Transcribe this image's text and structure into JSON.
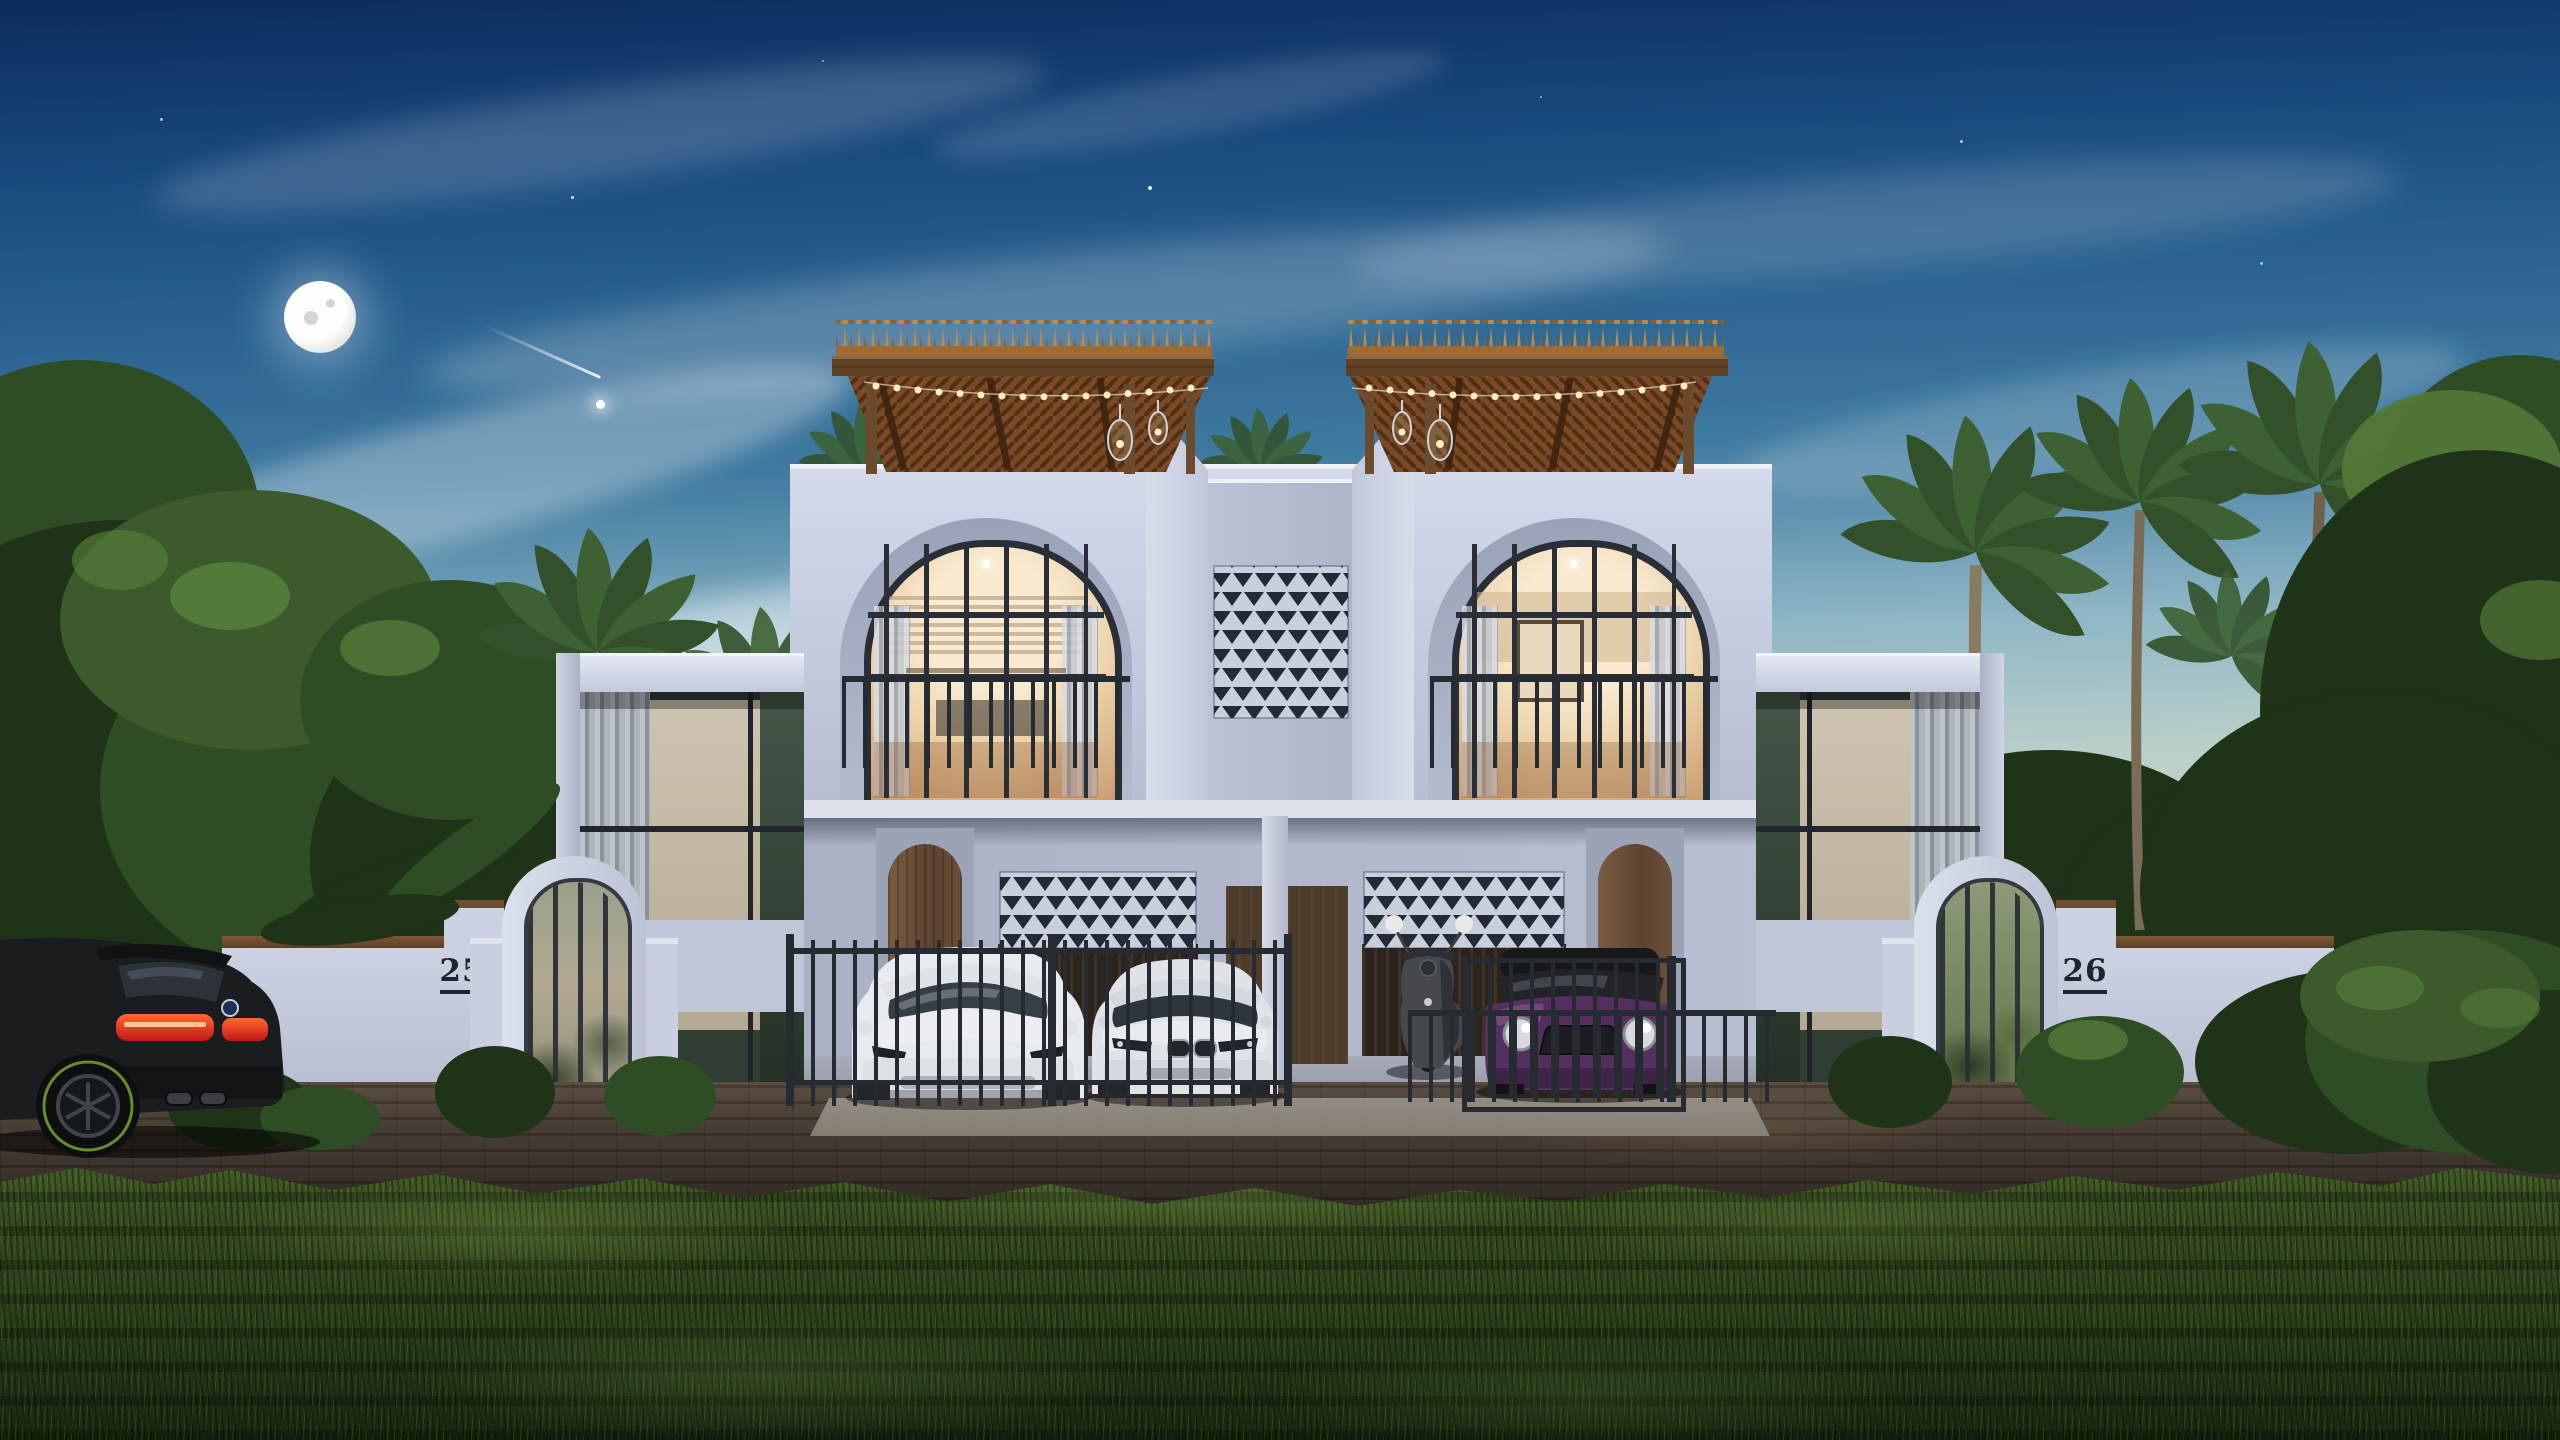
{
  "scene": {
    "left_unit_number": "25",
    "right_unit_number": "26"
  },
  "colors": {
    "skyTop": "#0b2c5c",
    "skyUpper": "#18497c",
    "skyMid": "#3f7aa0",
    "skyLow": "#8fb7c6",
    "skyHaze": "#d7d9c3",
    "horizon": "#f2e6c4",
    "cloud": "#ffffff",
    "moon": "#f4f6f0",
    "wallLight": "#d4daea",
    "wall": "#c6cdde",
    "wallMid": "#b6bdd0",
    "wallShade": "#a0a8bd",
    "nicheShade": "#9aa2b9",
    "frameDark": "#2a2f37",
    "glowTop": "#f9ead0",
    "glowMid": "#ecd3ab",
    "glowDeep": "#c49a6d",
    "woodDoor": "#6b4e36",
    "woodDark": "#4e3c2b",
    "thatchA": "#c08a45",
    "thatchB": "#8f5f2e",
    "fascia": "#5f4226",
    "soffit": "#7a4a26",
    "soffitLine": "#45280f",
    "post": "#6b4b2c",
    "bulb": "#ffedbe",
    "metal": "#262b31",
    "panelLight": "#c9cfdc",
    "panelDark": "#242a35",
    "folDark": "#1e3317",
    "folMid": "#2f4d24",
    "folLight": "#527a38",
    "palmLight": "#4c7030",
    "trunk": "#7b6c55",
    "roadLight": "#5a4d42",
    "roadDark": "#2e2822",
    "apron": "#8b857a",
    "grassLight": "#46622a",
    "grassMid": "#2c4119",
    "grassDark": "#18270f",
    "carWhite": "#e7eaee",
    "carSilver": "#dfe3e8",
    "mini": "#55305e",
    "miniRoof": "#17181a",
    "suv": "#1a1d1f",
    "tailA": "#ff6a30",
    "tailB": "#c11616",
    "rimGreen": "#6f9c2e",
    "scooter": "#45494e",
    "plaque": "#20242c"
  }
}
